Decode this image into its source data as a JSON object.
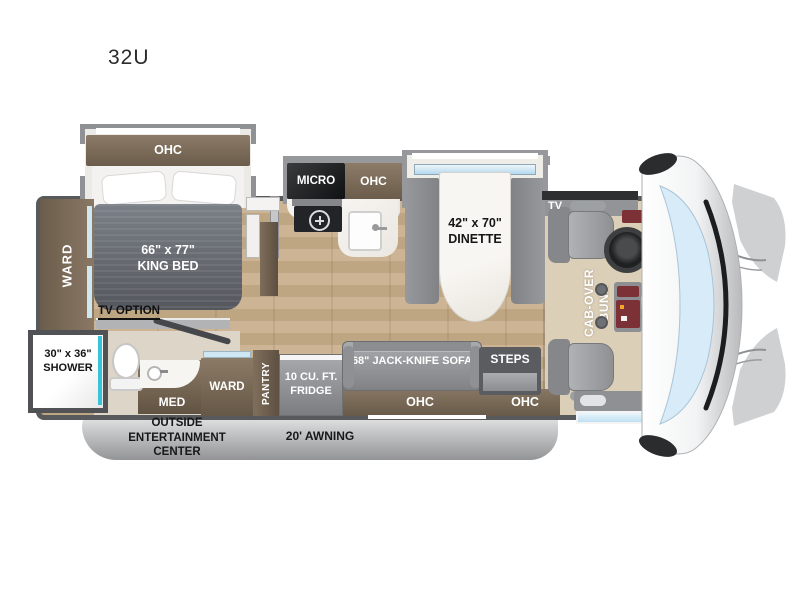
{
  "title": "32U",
  "colors": {
    "wall": "#58595b",
    "slide_wall": "#97999c",
    "floor_wood": "#c8b295",
    "cabinet_brown": "#7b6a56",
    "bed_gray": "#6a6f76",
    "seat_gray": "#9a9c9f",
    "window_blue": "#cfe7f6",
    "shower_teal": "#38c4d8",
    "console_red": "#7c3136",
    "skirt_gray": "#c0c1c3"
  },
  "bedroom": {
    "ohc_label": "OHC",
    "bed_size": "66\" x 77\"",
    "bed_type": "KING BED",
    "ward_label": "WARD",
    "tv_option_label": "TV OPTION"
  },
  "bath": {
    "shower_size": "30\" x 36\"",
    "shower_label": "SHOWER",
    "med_label": "MED"
  },
  "kitchen": {
    "micro_label": "MICRO",
    "ohc_label": "OHC",
    "dinette_size": "42\" x 70\"",
    "dinette_label": "DINETTE"
  },
  "living": {
    "ward_label": "WARD",
    "pantry_label": "PANTRY",
    "fridge_line1": "10 CU. FT.",
    "fridge_line2": "FRIDGE",
    "sofa_label": "68\" JACK-KNIFE SOFA",
    "ohc_under_sofa_label": "OHC",
    "steps_label": "STEPS",
    "ohc_entry_label": "OHC"
  },
  "cab": {
    "tv_label": "TV",
    "bunk_line1": "CAB-OVER",
    "bunk_line2": "BUNK"
  },
  "exterior": {
    "outside_line1": "OUTSIDE",
    "outside_line2": "ENTERTAINMENT",
    "outside_line3": "CENTER",
    "awning_label": "20' AWNING"
  }
}
